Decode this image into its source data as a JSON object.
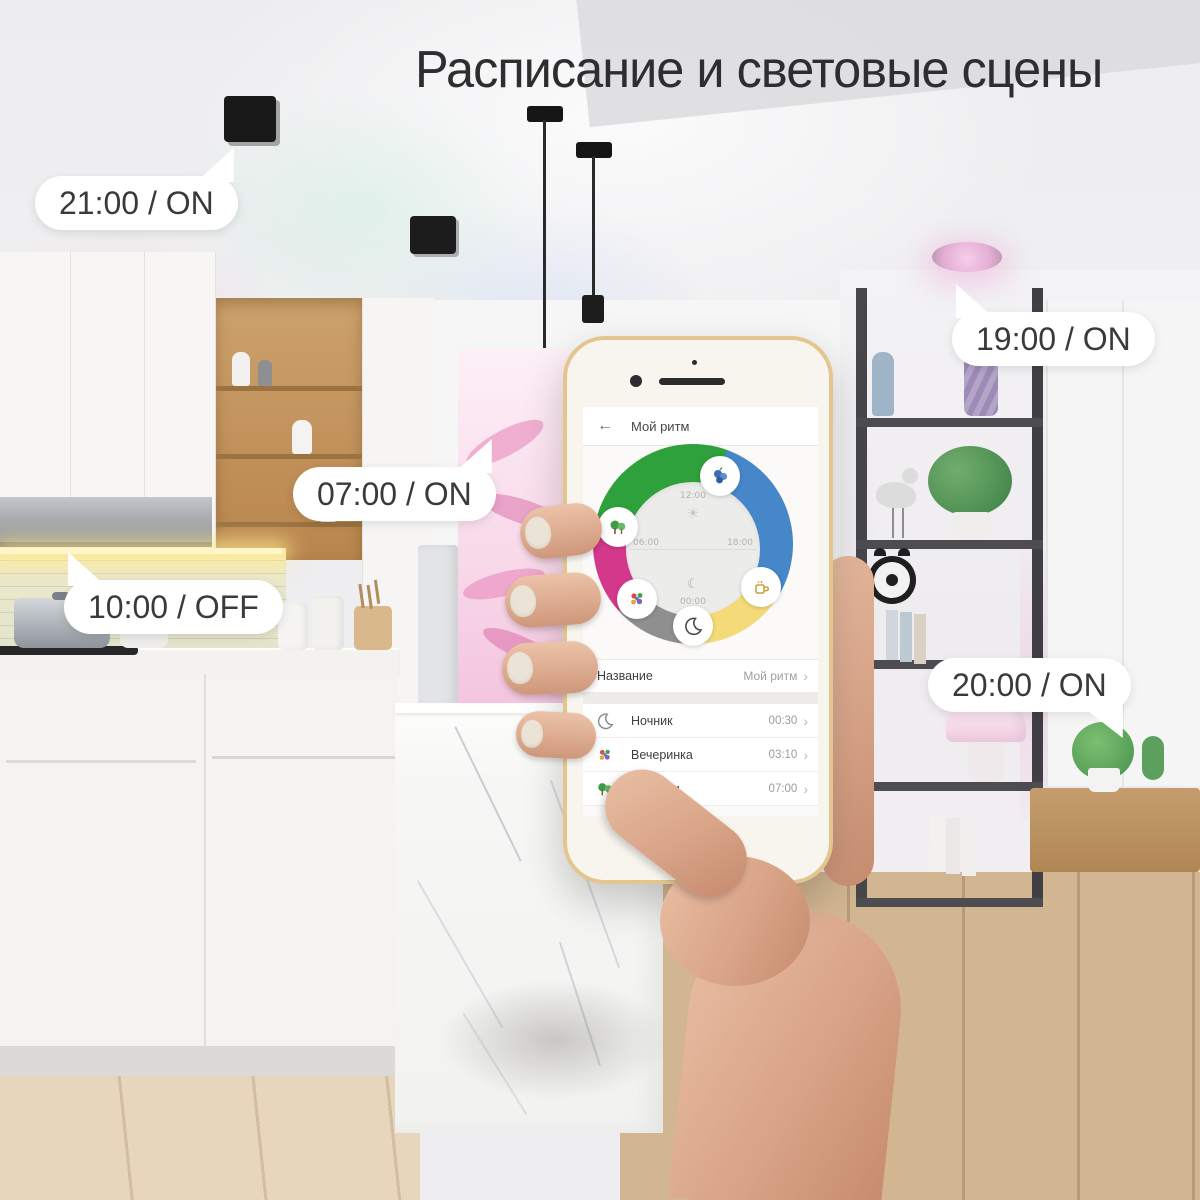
{
  "title": "Расписание и световые сцены",
  "callouts": [
    {
      "label": "21:00 / ON"
    },
    {
      "label": "19:00 / ON"
    },
    {
      "label": "07:00 / ON"
    },
    {
      "label": "10:00 / OFF"
    },
    {
      "label": "20:00 / ON"
    }
  ],
  "icons": {
    "back_arrow": "←",
    "chevron": "›",
    "sun": "☀",
    "moon": "☾"
  },
  "phone_app": {
    "header": {
      "title": "Мой ритм"
    },
    "dial": {
      "time_top": "12:00",
      "time_right": "18:00",
      "time_bottom": "00:00",
      "time_left": "06:00",
      "segment_colors": {
        "green": "#2fa13c",
        "blue": "#4687c9",
        "yellow": "#f4da78",
        "gray": "#8f8f8f",
        "magenta": "#d4388b"
      },
      "badges": [
        "berries-icon",
        "jungle-icon",
        "party-icon",
        "night-moon-icon",
        "coffee-icon"
      ]
    },
    "name_row": {
      "label": "Название",
      "value": "Мой ритм"
    },
    "scenes": [
      {
        "icon": "moon-icon",
        "name": "Ночник",
        "time": "00:30"
      },
      {
        "icon": "party-icon",
        "name": "Вечеринка",
        "time": "03:10"
      },
      {
        "icon": "jungle-icon",
        "name": "Джунгли",
        "time": "07:00"
      }
    ]
  },
  "colors": {
    "phone_frame_gold": "#e3c68f",
    "under_cabinet_glow": "#ffe98f",
    "accent_pink_light": "#f2c3e0",
    "bubble_background": "#ffffff",
    "title_text": "#2e2e30"
  }
}
